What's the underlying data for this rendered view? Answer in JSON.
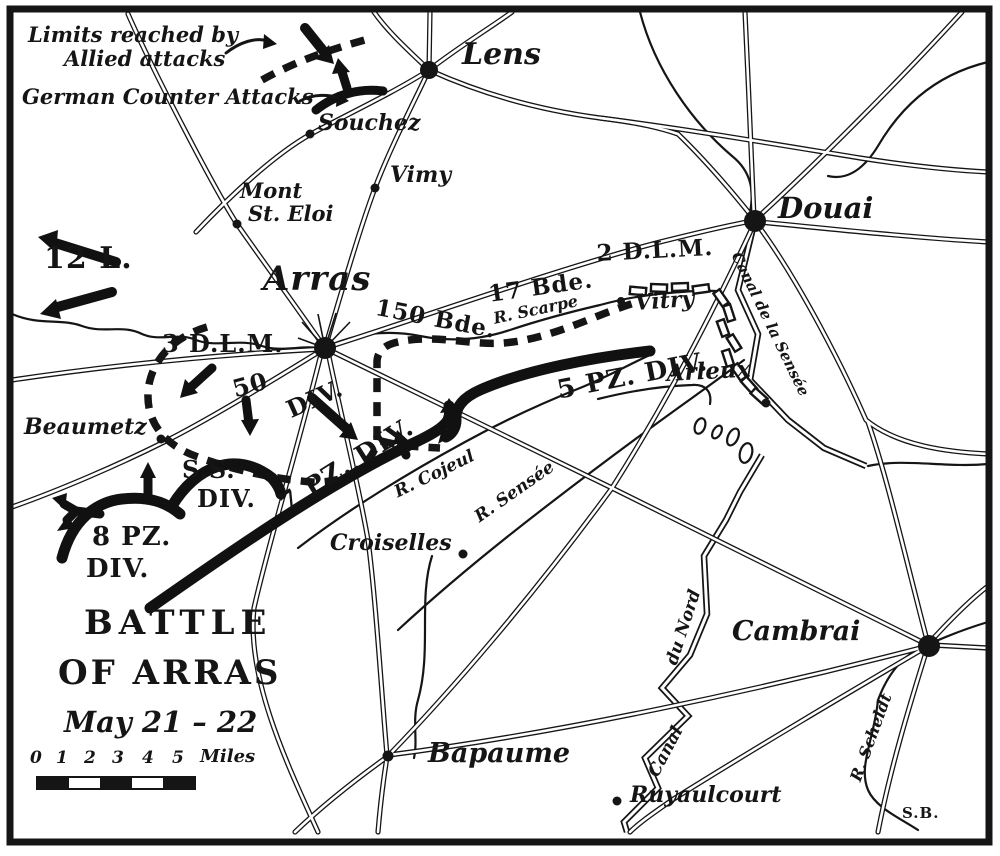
{
  "colors": {
    "ink": "#151515",
    "paper": "#ffffff"
  },
  "legend": {
    "allied_line1": "Limits reached by",
    "allied_line2": "Allied attacks",
    "german_label": "German Counter Attacks"
  },
  "title": {
    "line1": "BATTLE",
    "line2": "OF ARRAS",
    "date": "May 21 – 22"
  },
  "scale": {
    "ticks": [
      "0",
      "1",
      "2",
      "3",
      "4",
      "5"
    ],
    "unit": "Miles"
  },
  "credit": "S.B.",
  "towns": {
    "lens": "Lens",
    "souchez": "Souchez",
    "vimy": "Vimy",
    "mont_line1": "Mont",
    "mont_line2": "St. Eloi",
    "arras": "Arras",
    "douai": "Douai",
    "vitry": "Vitry",
    "arleux": "Arleux",
    "beaumetz": "Beaumetz",
    "croiselles": "Croiselles",
    "cambrai": "Cambrai",
    "bapaume": "Bapaume",
    "ruyaulcourt": "Ruyaulcourt"
  },
  "waterways": {
    "r_scarpe": "R. Scarpe",
    "r_cojeul": "R. Cojeul",
    "r_sensee": "R. Sensée",
    "canal_de_la_sensee": "Canal de la Sensée",
    "canal_du_nord_word1": "Canal",
    "canal_du_nord_word2": "du Nord",
    "r_scheldt": "R. Scheldt"
  },
  "units": {
    "l12": "12 L.",
    "dlm3": "3 D.L.M.",
    "div50_num": "50",
    "div50_word": "DIV.",
    "bde150": "150 Bde.",
    "bde17": "17 Bde.",
    "dlm2": "2 D.L.M.",
    "pz5": "5 PZ. DIV.",
    "pz7": "7 PZ. DIV.",
    "ss_line1": "S.S.",
    "ss_line2": "DIV.",
    "pz8_line1": "8 PZ.",
    "pz8_line2": "DIV."
  }
}
